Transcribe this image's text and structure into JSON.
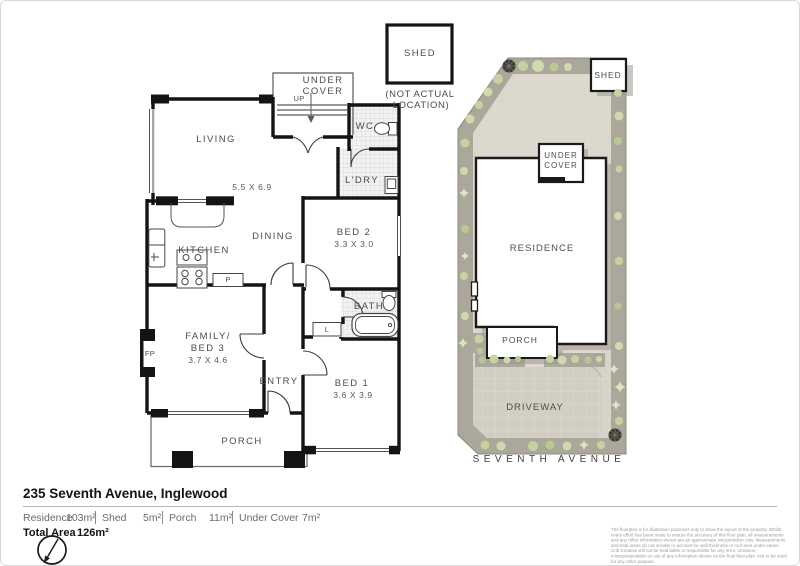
{
  "floorplan": {
    "living": "LIVING",
    "living_dims": "5.5 X 6.9",
    "under_cover_1": "UNDER",
    "under_cover_2": "COVER",
    "up": "UP",
    "wc": "WC",
    "ldry": "L'DRY",
    "shed": "SHED",
    "shed_note_1": "(NOT ACTUAL",
    "shed_note_2": "LOCATION)",
    "kitchen": "KITCHEN",
    "dining": "DINING",
    "pantry": "P",
    "bed2": "BED 2",
    "bed2_dims": "3.3 X 3.0",
    "bath": "BATH",
    "linen": "L",
    "family_1": "FAMILY/",
    "family_2": "BED 3",
    "family_dims": "3.7 X 4.6",
    "fireplace": "FP",
    "entry": "ENTRY",
    "bed1": "BED 1",
    "bed1_dims": "3.6 X 3.9",
    "porch": "PORCH"
  },
  "siteplan": {
    "shed": "SHED",
    "under_cover_1": "UNDER",
    "under_cover_2": "COVER",
    "residence": "RESIDENCE",
    "porch": "PORCH",
    "driveway": "DRIVEWAY",
    "street": "SEVENTH AVENUE"
  },
  "footer": {
    "address": "235 Seventh Avenue, Inglewood",
    "areas": [
      {
        "label": "Residence",
        "value": "103m²"
      },
      {
        "label": "Shed",
        "value": "5m²"
      },
      {
        "label": "Porch",
        "value": "11m²"
      },
      {
        "label": "Under Cover",
        "value": "7m²"
      }
    ],
    "total_label": "Total Area",
    "total_value": "126m²",
    "disclaimer": "The floorplan is for illustration purposes only to show the layout of the property. Whilst every effort has been made to ensure the accuracy of this floor plan, all measurements and any other information shown are an approximate interpretation only. Measurements and total areas do not include or account for wall thickness or roof area under eaves. Crib Creative will not be held liable or responsible for any error, omission, misrepresentation or use of any information shown on the final floor plan. Not to be used for any other purpose.",
    "website": "www.cribcreative.com.au"
  },
  "colors": {
    "wall": "#141414",
    "garden_border": "#aca79b",
    "yard": "#dbd7cc",
    "driveway": "#d2cec3",
    "plant_green": "#c6d3a1",
    "label_gray": "#4c4c4e"
  }
}
